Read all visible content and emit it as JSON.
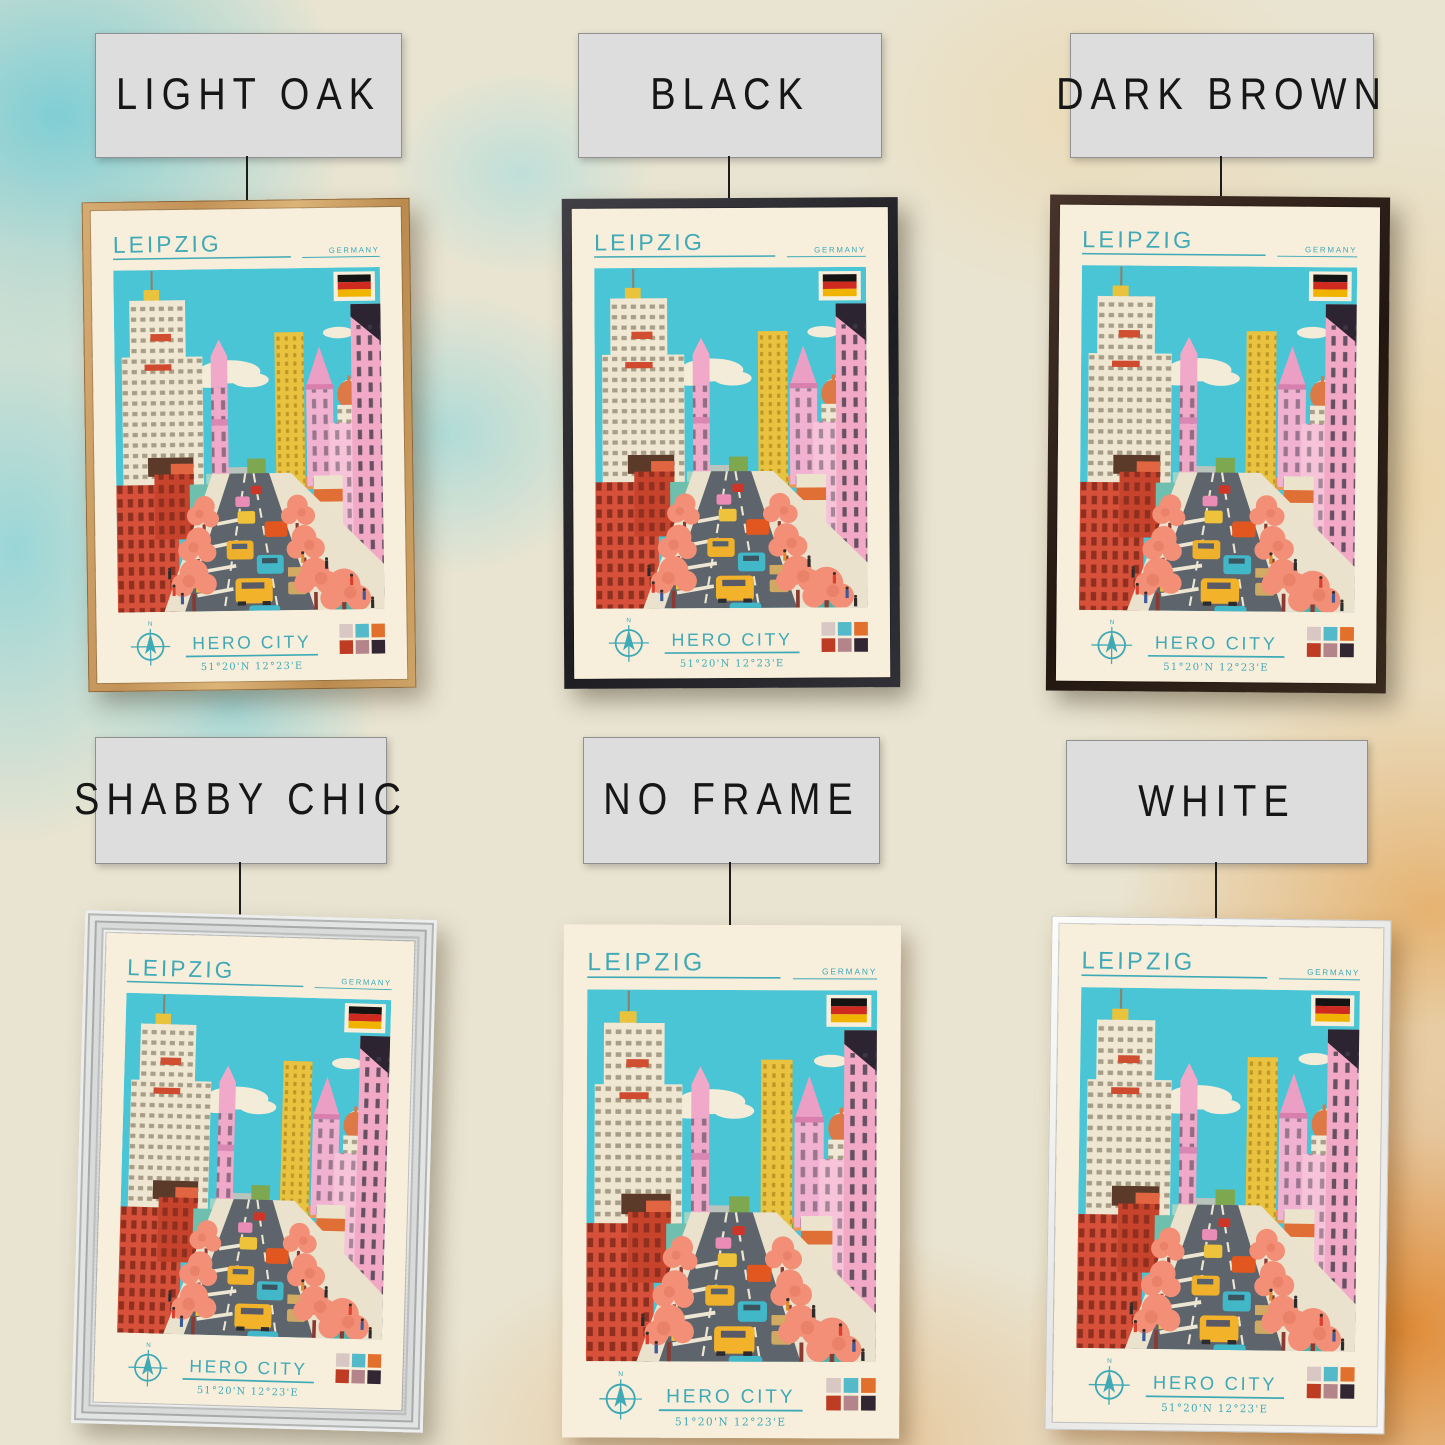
{
  "wall": {
    "base_color": "#e9e4d1",
    "teal_wash": "#7ccfd8",
    "orange_wash": "#e2892e"
  },
  "variants": [
    {
      "id": "light-oak",
      "label": "LIGHT OAK",
      "frame_color": "#c59a63"
    },
    {
      "id": "black",
      "label": "BLACK",
      "frame_color": "#2b2b2e"
    },
    {
      "id": "dark-brown",
      "label": "DARK BROWN",
      "frame_color": "#35241b"
    },
    {
      "id": "shabby-chic",
      "label": "SHABBY CHIC",
      "frame_color": "#dddfde"
    },
    {
      "id": "no-frame",
      "label": "NO FRAME",
      "frame_color": "none"
    },
    {
      "id": "white",
      "label": "WHITE",
      "frame_color": "#f2f2f0"
    }
  ],
  "poster": {
    "city": "LEIPZIG",
    "country": "GERMANY",
    "subtitle": "HERO CITY",
    "coordinates": "51°20'N 12°23'E",
    "compass_label": "N",
    "accent_color": "#3fa9b6",
    "paper_color": "#f7efdc",
    "sky_color": "#49c5d5",
    "flag": {
      "stripes": [
        "#161413",
        "#cf2a1f",
        "#f0b400"
      ]
    },
    "palette": [
      "#d8c7c3",
      "#54b9c9",
      "#e2702d",
      "#bf3c24",
      "#b4848b",
      "#322633"
    ]
  }
}
